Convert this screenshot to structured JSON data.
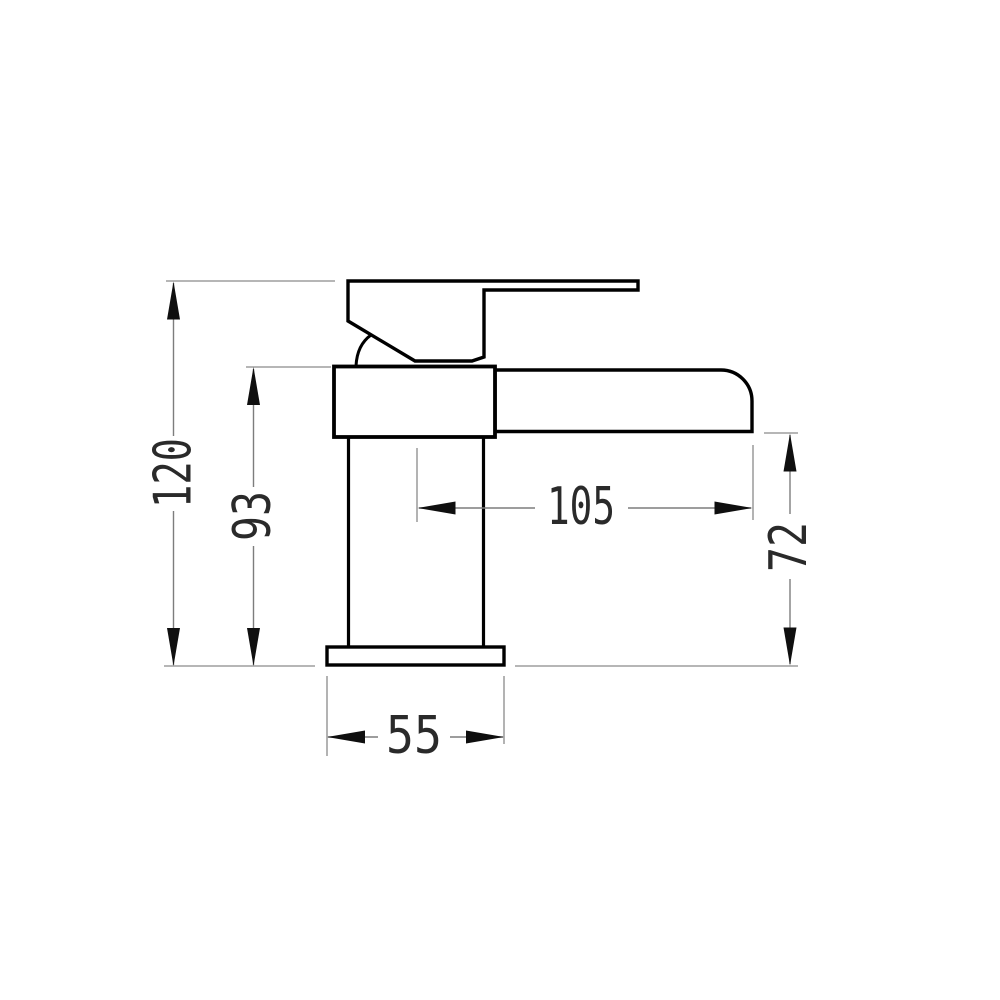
{
  "drawing": {
    "kind": "technical-dimension-drawing",
    "colors": {
      "background": "#ffffff",
      "outline": "#000000",
      "dimension_line": "#7d7d7d",
      "arrow": "#0f0f0f",
      "text": "#2a2a2a"
    },
    "dimensions": {
      "overall_height": {
        "value": "120"
      },
      "body_height": {
        "value": "93"
      },
      "spout_reach": {
        "value": "105"
      },
      "spout_height": {
        "value": "72"
      },
      "base_width": {
        "value": "55"
      }
    }
  }
}
